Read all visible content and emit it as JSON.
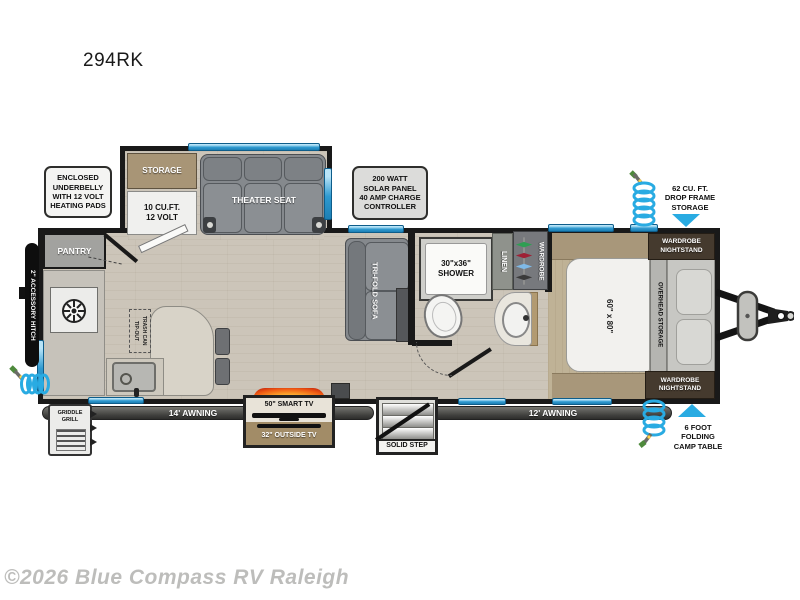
{
  "title": "294RK",
  "copyright": "©2026 Blue Compass RV Raleigh",
  "colors": {
    "accent_blue": "#29abe2",
    "wall_black": "#191919",
    "floor_beige": "#ccc5b9",
    "bedroom_tan": "#bfb296",
    "furniture_gray": "#85898d",
    "nightstand_brown": "#453a2e",
    "awning_bar_gray": "#4d4d4d",
    "flame_orange": "#ef5a14"
  },
  "callouts": {
    "underbelly": "ENCLOSED\nUNDERBELLY\nWITH 12 VOLT\nHEATING PADS",
    "solar": "200 WATT\nSOLAR PANEL\n40 AMP CHARGE\nCONTROLLER",
    "drop_frame": "62 CU. FT.\nDROP FRAME\nSTORAGE",
    "camp_table": "6 FOOT\nFOLDING\nCAMP TABLE"
  },
  "rooms": {
    "storage": "STORAGE",
    "fridge": "10 CU.FT.\n12 VOLT",
    "theater": "THEATER SEAT",
    "pantry": "PANTRY",
    "accessory_hitch": "2\" ACCESSORY HITCH",
    "trash": "TIP-OUT\nTRASH CAN",
    "sofa": "TRI-FOLD SOFA",
    "shower": "30\"x36\"\nSHOWER",
    "linen": "LINEN",
    "wardrobe": "WARDROBE",
    "bed": "60\" x 80\"",
    "overhead": "OVERHEAD STORAGE",
    "nightstand": "WARDROBE\nNIGHTSTAND",
    "griddle": "GRIDDLE\nGRILL",
    "awning14": "14' AWNING",
    "awning12": "12' AWNING",
    "tv50": "50\" SMART TV",
    "tv32": "32\" OUTSIDE TV",
    "step": "SOLID STEP"
  }
}
